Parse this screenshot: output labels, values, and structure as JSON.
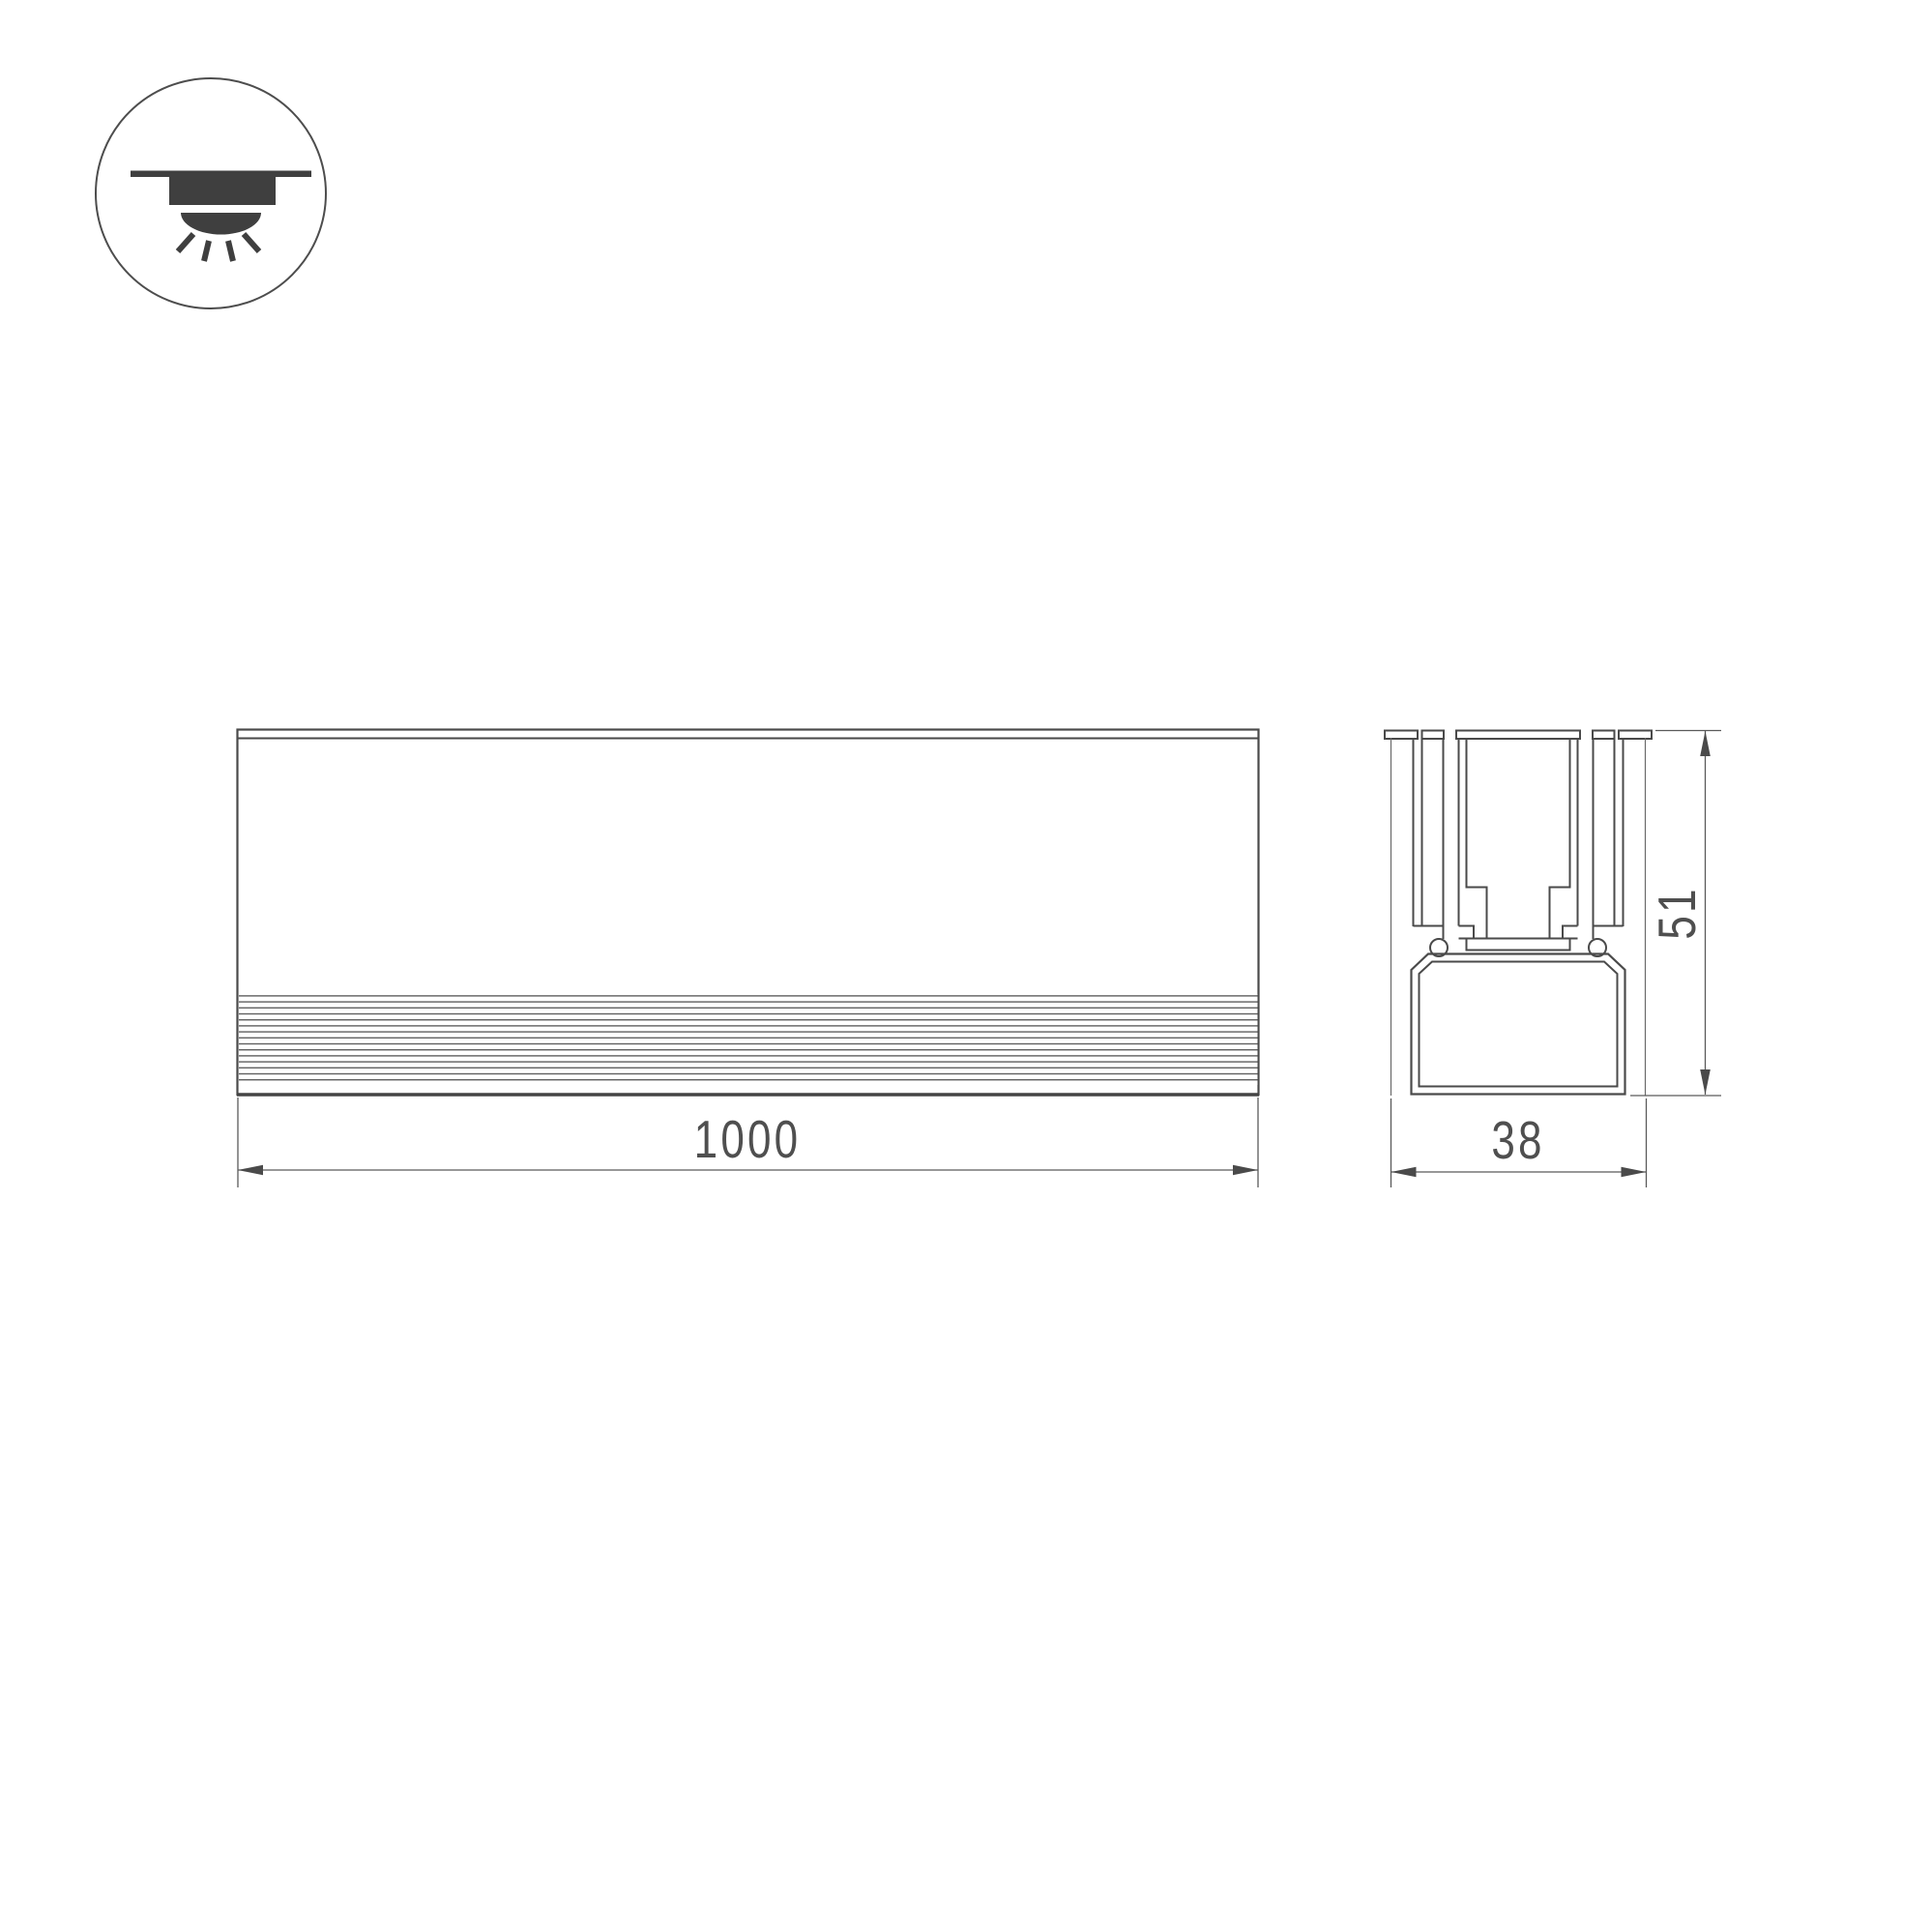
{
  "drawing": {
    "icon": {
      "label": "recessed-downlight"
    },
    "front_view": {
      "length_dim": "1000"
    },
    "section_view": {
      "width_dim": "38",
      "height_dim": "51"
    }
  },
  "colors": {
    "background": "#ffffff",
    "line": "#4a4a4a",
    "thin_line": "#6a6a6a",
    "dim_line": "#5a5a5a",
    "text": "#4f4f4f",
    "icon_fill": "#3f3f3f"
  }
}
